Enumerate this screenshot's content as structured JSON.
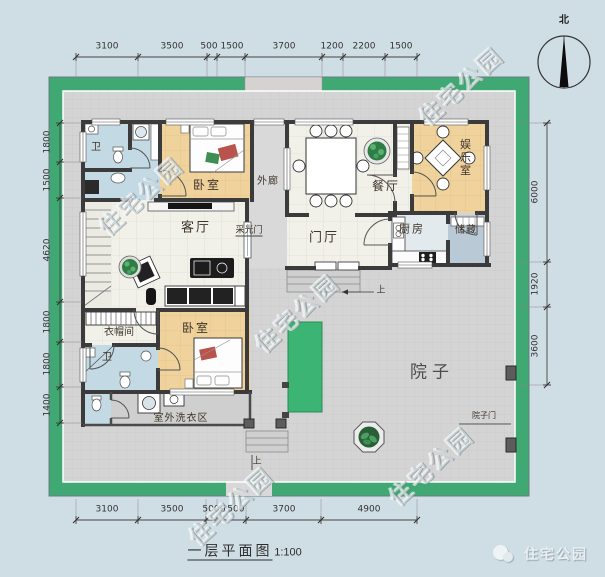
{
  "meta": {
    "title": "一层平面图",
    "scale": "1:100",
    "north_label": "北",
    "watermark_text": "住宅公园",
    "logo_text": "住宅公园"
  },
  "rooms": {
    "bath_top": "卫",
    "bedroom_top": "卧室",
    "corridor": "外廊",
    "dining": "餐厅",
    "recreation": "娱乐室",
    "living": "客厅",
    "light_door": "采光门",
    "foyer": "门厅",
    "kitchen": "厨房",
    "storage": "储藏",
    "cloakroom": "衣帽间",
    "bedroom_bottom": "卧室",
    "bath_bottom": "卫",
    "laundry": "室外洗衣区",
    "courtyard": "院子",
    "courtyard_gate": "院子门",
    "up_entry": "上",
    "up_yard": "上"
  },
  "dimensions": {
    "top": [
      "3100",
      "3500",
      "500",
      "1500",
      "3700",
      "1200",
      "2200",
      "1500"
    ],
    "bottom": [
      "3100",
      "3500",
      "500",
      "1500",
      "3700",
      "4900"
    ],
    "left": [
      "1800",
      "1500",
      "4620",
      "1800",
      "1800",
      "1400"
    ],
    "right": [
      "6000",
      "1920",
      "3600"
    ]
  },
  "colors": {
    "site_wall_green": "#3fa873",
    "floor_orange": "#f0d29c",
    "floor_blue": "#c3d9e3",
    "storage_blue": "#b9c9d5",
    "paving_gray": "#d4d4d4",
    "grass_green": "#3cb473",
    "wall_dark": "#3b3b3b",
    "background": "#cfdde4"
  }
}
